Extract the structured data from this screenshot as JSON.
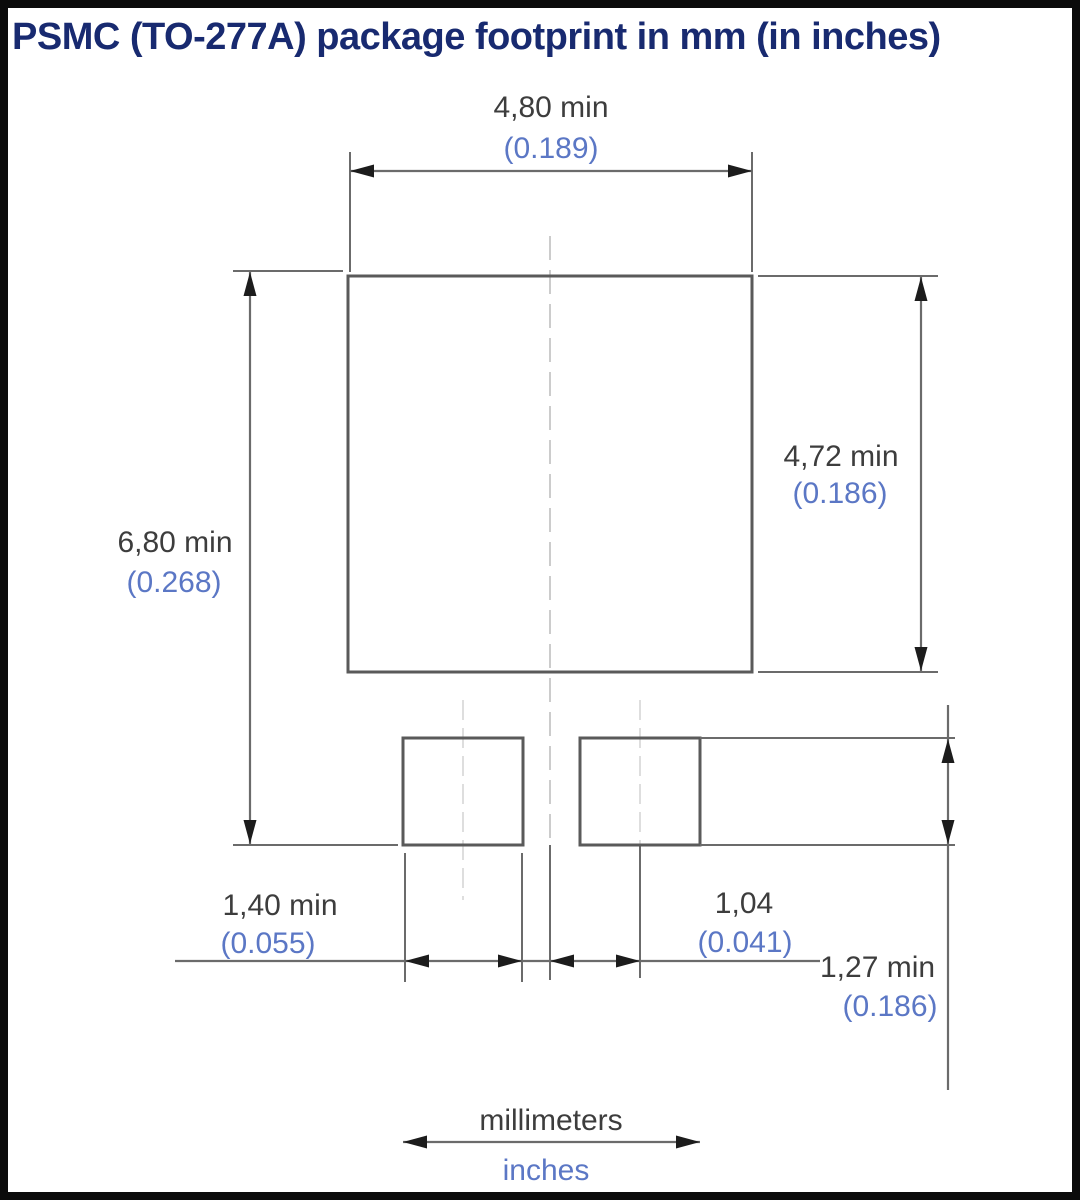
{
  "title": "PSMC (TO-277A) package footprint in mm (in inches)",
  "dims": {
    "body_width": {
      "mm": "4,80 min",
      "inch": "(0.189)"
    },
    "body_height": {
      "mm": "4,72 min",
      "inch": "(0.186)"
    },
    "overall_height": {
      "mm": "6,80 min",
      "inch": "(0.268)"
    },
    "lead_pad_width": {
      "mm": "1,40 min",
      "inch": "(0.055)"
    },
    "lead_pad_offset": {
      "mm": "1,04",
      "inch": "(0.041)"
    },
    "lead_pad_height": {
      "mm": "1,27 min",
      "inch": "(0.186)"
    }
  },
  "legend": {
    "millimeters": "millimeters",
    "inches": "inches"
  },
  "colors": {
    "title_text": "#182a70",
    "mm_text": "#3d3d3d",
    "inch_text": "#5b77c5",
    "drawing_line": "#6b6b6b",
    "pad_outline": "#5a5a5a",
    "centerline": "#c6c6c6",
    "arrowhead": "#1c1c1c",
    "frame": "#0b0b0b",
    "background": "#ffffff"
  }
}
